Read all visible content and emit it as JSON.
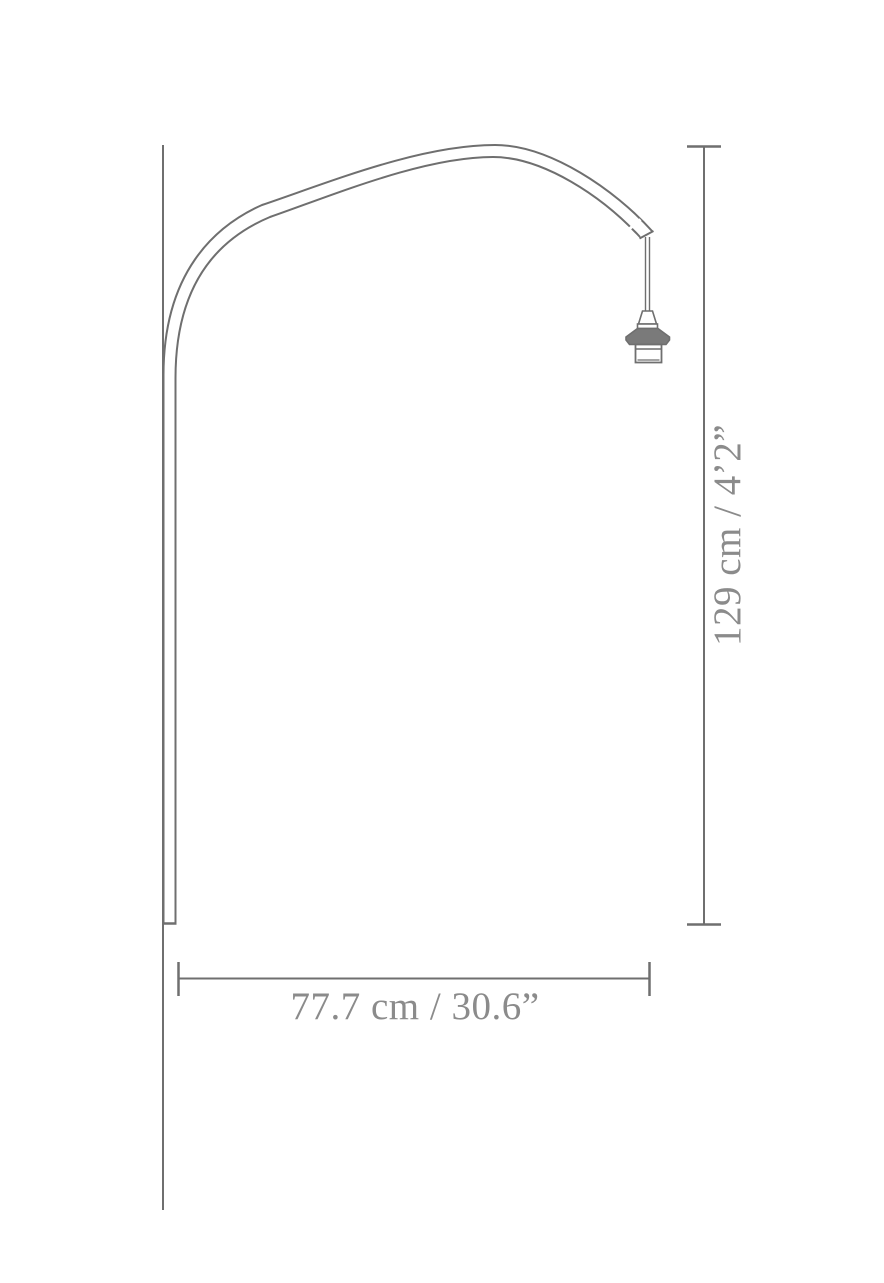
{
  "diagram": {
    "type": "product-dimension-drawing",
    "subject": "arched lamp with wall-mounted stem and hanging socket",
    "dimensions": {
      "height_label": "129 cm / 4’2”",
      "width_label": "77.7 cm / 30.6”"
    },
    "colors": {
      "line": "#6f6f6f",
      "text": "#8b8b8b",
      "socket_fill": "#7a7a7a",
      "background": "#ffffff"
    }
  }
}
